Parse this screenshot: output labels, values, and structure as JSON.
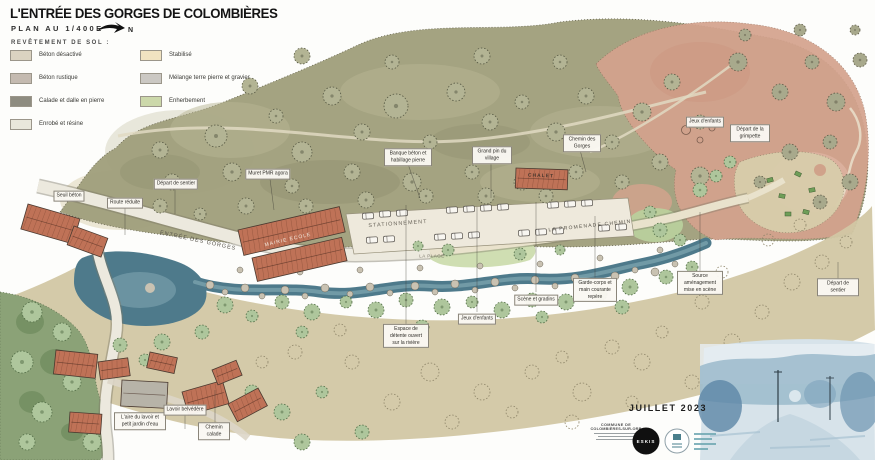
{
  "header": {
    "title": "L'ENTRÉE DES GORGES DE COLOMBIÈRES",
    "scale": "PLAN AU 1/400E",
    "north": "N",
    "legend_heading": "REVÊTEMENT DE SOL :"
  },
  "legend": {
    "items": [
      {
        "label": "Béton désactivé",
        "color": "#dbd3c1"
      },
      {
        "label": "Béton rustique",
        "color": "#c4bab0"
      },
      {
        "label": "Calade et dalle en pierre",
        "color": "#8e8c80"
      },
      {
        "label": "Enrobé et résine",
        "color": "#e9e7db"
      },
      {
        "label": "Stabilisé",
        "color": "#f1e3c1"
      },
      {
        "label": "Mélange terre pierre et gravier",
        "color": "#cbc8c3"
      },
      {
        "label": "Enherbement",
        "color": "#ccd8aa"
      }
    ]
  },
  "map": {
    "labels": {
      "seuil_beton": "Seuil béton",
      "route_reduite": "Route réduite",
      "depart_sentier_ouest": "Départ de sentier",
      "muret_pmr": "Muret PMR agora",
      "banque_beton": "Banque béton et habillage pierre",
      "grand_pin": "Grand pin du village",
      "chemin_des_gorges": "Chemin des Gorges",
      "jeux_enfants_nord": "Jeux d'enfants",
      "grimpette": "Départ de la grimpette",
      "espace_detente": "Espace de détente ouvert sur la rivière",
      "jeux_enfants_sud": "Jeux d'enfants",
      "scene_gradins": "Scène et gradins",
      "garde_corps": "Garde-corps et main courante repère",
      "source": "Source aménagement mise en scène",
      "depart_sentier_est": "Départ de sentier",
      "lavoir_jardin": "L'aire du lavoir et petit jardin d'eau",
      "lavoir_belvedere": "Lavoir belvédère",
      "chemin_calade": "Chemin calade"
    },
    "areas": {
      "entree_gorges": "ENTRÉE DES GORGES",
      "stationnement": "STATIONNEMENT",
      "la_plage": "LA PLAGE",
      "promenade": "LA PROMENADE CHEMIN",
      "mairie_ecole": "MAIRIE ÉCOLE",
      "chalet": "CHALET"
    },
    "palette": {
      "hill": "#a1a07d",
      "rock_pink": "#d4a28d",
      "lowland_tan": "#d2c7a4",
      "water": "#4e7a8b",
      "vegetation": "#aec69c",
      "roof_red": "#bf7257"
    }
  },
  "footer": {
    "date": "JUILLET 2023",
    "commune_line1": "COMMUNE DE",
    "commune_line2": "COLOMBIÈRES-SUR-ORB",
    "eskis_logo": "ESKIS"
  }
}
